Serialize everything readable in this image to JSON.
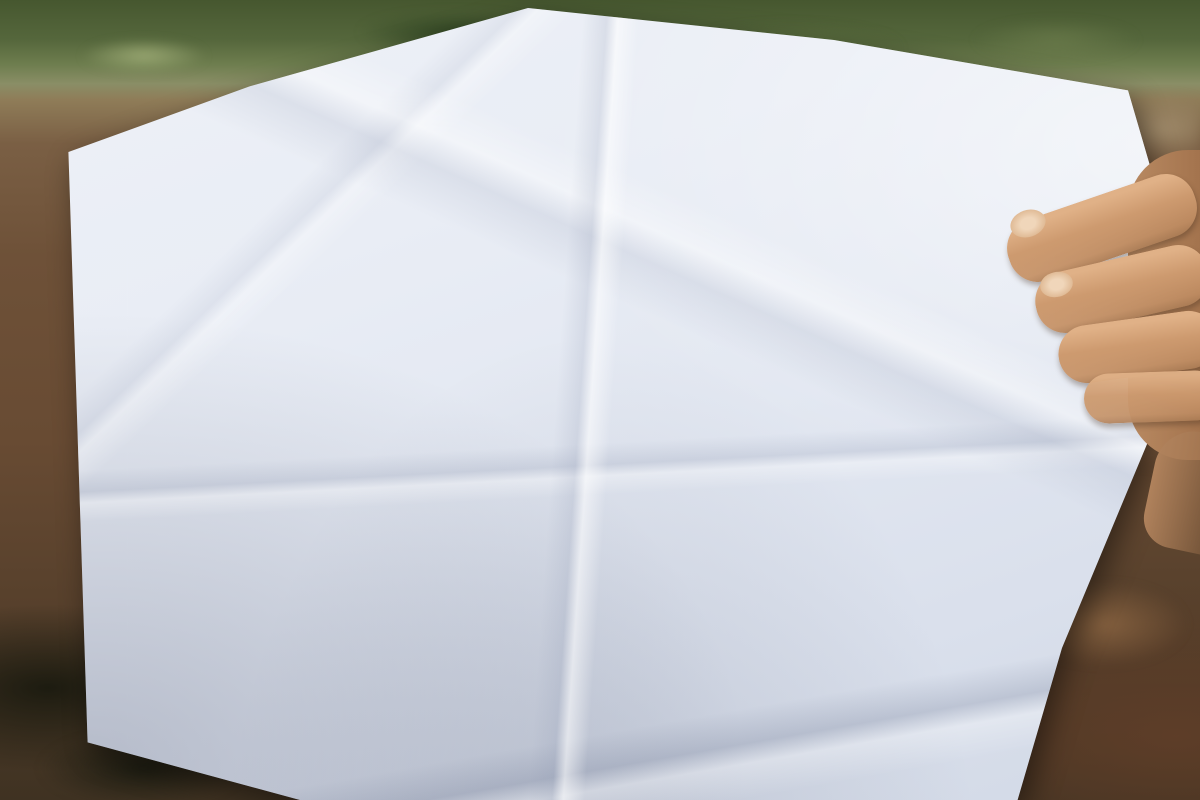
{
  "photo": {
    "watermark_text": "BHT"
  },
  "plan": {
    "ink_color": "#333d54",
    "pen_color": "#3c50a8",
    "top_edge_dims": [
      {
        "t": "6,98",
        "x": 594,
        "y": 20,
        "r": 10
      },
      {
        "t": "11,37",
        "x": 646,
        "y": 36,
        "r": 17
      },
      {
        "t": "26,31",
        "x": 703,
        "y": 57,
        "r": 16
      },
      {
        "t": "7,78",
        "x": 757,
        "y": 73,
        "r": 10
      },
      {
        "t": "7,01",
        "x": 789,
        "y": 80,
        "r": 8
      }
    ],
    "boundary_dims": [
      {
        "t": "96,01",
        "x": 560,
        "y": 228,
        "r": -80
      },
      {
        "t": "105,00",
        "x": 787,
        "y": 272,
        "r": -87
      },
      {
        "t": "21,07",
        "x": 322,
        "y": 636,
        "r": -76
      },
      {
        "t": "21,07",
        "x": 362,
        "y": 641,
        "r": -76
      }
    ],
    "road_labels": [
      {
        "t": "Đường 12 M",
        "x": 334,
        "y": 484,
        "r": -84
      },
      {
        "t": "Đường 7 m",
        "x": 566,
        "y": 332,
        "r": -80
      },
      {
        "t": "Đường 7m",
        "x": 801,
        "y": 388,
        "r": -68
      },
      {
        "t": "Đường 7 m",
        "x": 905,
        "y": 524,
        "r": -84
      },
      {
        "t": "Đường 7 m",
        "x": 597,
        "y": 691,
        "r": -6
      }
    ],
    "blocks": {
      "A": {
        "top_labels": [
          {
            "t": "21,90",
            "x": 43,
            "y": -5
          },
          {
            "t": "21,94",
            "x": 129,
            "y": -5
          }
        ],
        "left_rows": [
          [
            "A1",
            "153,2",
            "21,88",
            "7,00"
          ],
          [
            "A2",
            "153,0",
            "21,86",
            "7,00"
          ],
          [
            "A3",
            "152,8",
            "21,83",
            "7,00"
          ],
          [
            "A4",
            "152,6",
            "21,80",
            "7,00"
          ],
          [
            "A5",
            "152,5",
            "21,78",
            "7,00"
          ],
          [
            "A6",
            "152,3",
            "21,75",
            "7,00"
          ],
          [
            "A7",
            "152,1",
            "21,73",
            "7,00"
          ],
          [
            "A8",
            "151,9",
            "21,70",
            "7,00"
          ],
          [
            "A9",
            "151,8",
            "21,68",
            "7,00"
          ],
          [
            "A10",
            "151,6",
            "21,65",
            "7,00"
          ],
          [
            "A11",
            "151,4",
            "21,63",
            "7,00"
          ],
          [
            "A12",
            "151,2",
            "21,60",
            "7,00"
          ],
          [
            "A13",
            "161,0",
            "21,33",
            "7,50"
          ],
          [
            "A14",
            "158,9",
            "21,07",
            "7,50"
          ],
          [
            "A15",
            "155,9",
            "20,80",
            "7,50"
          ],
          [
            "A16",
            "154,9",
            "20,53",
            "7,50"
          ],
          [
            "A17",
            "152,7",
            "",
            "7,50"
          ]
        ],
        "right_rows": [
          [
            "A39",
            "153,4",
            "21,91",
            "7,00"
          ],
          [
            "A38",
            "153,2",
            "21,88",
            "7,00"
          ],
          [
            "A37",
            "153,0",
            "21,86",
            "7,00"
          ],
          [
            "A36",
            "152,8",
            "21,83",
            "7,00"
          ],
          [
            "A35",
            "152,6",
            "21,80",
            "7,00"
          ],
          [
            "A34",
            "152,3",
            "21,78",
            "7,00"
          ],
          [
            "A33",
            "152,2",
            "21,73",
            "7,00"
          ],
          [
            "A32",
            "152,0",
            "21,73",
            "7,00"
          ],
          [
            "A31",
            "151,9",
            "21,70",
            "7,00"
          ],
          [
            "A30",
            "151,7",
            "21,67",
            "7,00"
          ],
          [
            "A29",
            "151,5",
            "21,65",
            "7,00"
          ],
          [
            "A28",
            "151,4",
            "21,62",
            "7,00"
          ],
          [
            "A27",
            "161,1",
            "21,33",
            "7,50"
          ],
          [
            "A26",
            "158,9",
            "21,08",
            "7,50"
          ],
          [
            "A25",
            "157,1",
            "20,82",
            "7,50"
          ],
          [
            "A24",
            "155,1",
            "20,55",
            "7,50"
          ],
          [
            "A23",
            "152,9",
            "",
            "7,50"
          ]
        ],
        "strip": {
          "above": "5,21",
          "top_widths": [
            "7,40",
            "7,65",
            "2,44",
            "7,65",
            "10,19"
          ],
          "plots": [
            [
              "A18",
              "23,71",
              "171,5",
              "7,22"
            ],
            [
              "A19",
              "23,31",
              "169,6",
              "7,50"
            ],
            [
              "A20",
              "21,81",
              "158,1",
              "7,50"
            ],
            [
              "A21",
              "20,32",
              "146,8",
              "7,50"
            ],
            [
              "A22",
              "18,64",
              "178,2",
              "10,02"
            ]
          ],
          "right_side": "16,86"
        }
      },
      "B": {
        "top_labels": [
          {
            "t": "23,05",
            "x": 44,
            "y": -5
          },
          {
            "t": "23,06",
            "x": 146,
            "y": -5
          }
        ],
        "left_rows": [
          [
            "B1",
            "172,2",
            "22,90",
            "7,50"
          ],
          [
            "B2",
            "171,1",
            "22,76",
            "7,50"
          ],
          [
            "B3",
            "170,0",
            "22,61",
            "7,50"
          ],
          [
            "B4",
            "168,9",
            "22,47",
            "7,50"
          ],
          [
            "B5",
            "167,8",
            "",
            "7,50"
          ]
        ],
        "right_rows": [
          [
            "B16",
            "172,1",
            "22,91",
            "7,50"
          ],
          [
            "B15",
            "171,0",
            "22,77",
            "7,50"
          ],
          [
            "B14",
            "169,9",
            "22,62",
            "7,50"
          ],
          [
            "B13",
            "168,8",
            "22,47",
            "7,50"
          ],
          [
            "B12",
            "167,7",
            "",
            "7,50"
          ]
        ],
        "strip": {
          "top_widths": [
            "7,52",
            "7,40",
            "7,40",
            "7,52",
            "7,40",
            "7,40"
          ],
          "plots": [
            [
              "B6",
              "21,47",
              "158,4",
              "7,38"
            ],
            [
              "B7",
              "21,85",
              "158,6",
              "7,25"
            ],
            [
              "B8",
              "22,25",
              "161,5",
              "7,25"
            ],
            [
              "B9",
              "22,65",
              "166,5",
              "7,33"
            ],
            [
              "B10",
              "23,05",
              "167,2",
              "7,25"
            ],
            [
              "B11",
              "23,45",
              "170,1",
              "7,25"
            ]
          ]
        }
      },
      "C": {
        "top_label": {
          "t": "17,36",
          "x": 24,
          "y": -5
        },
        "rows": [
          [
            "C1",
            "125,9",
            "17,21",
            "7,30"
          ],
          [
            "C2",
            "124,7",
            "17,05",
            "7,50"
          ],
          [
            "C3",
            "123,6",
            "",
            "7,50"
          ]
        ],
        "strip": {
          "top_widths": [
            "8,40",
            "8,50"
          ],
          "plots": [
            [
              "C4",
              "16,49",
              "137,7",
              "6,50"
            ],
            [
              "C5",
              "16,07",
              "126,4",
              "8,50"
            ]
          ],
          "corner": "2,46",
          "right_side": "14,66"
        }
      }
    },
    "pen": {
      "circled_number": "12"
    }
  }
}
